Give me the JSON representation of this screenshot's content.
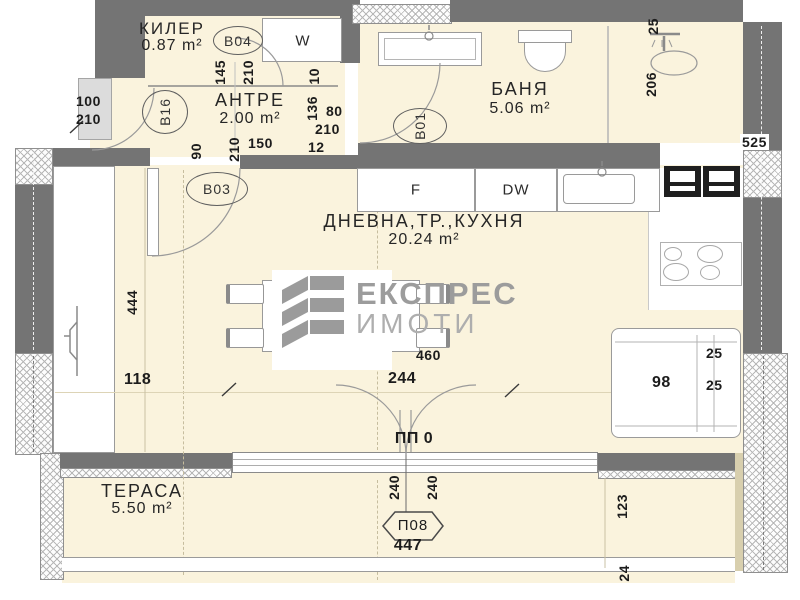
{
  "logo": {
    "title": "ЕКСПРЕС",
    "subtitle": "ИМОТИ"
  },
  "rooms": {
    "kiler": {
      "name": "КИЛЕР",
      "area": "0.87 m²",
      "tag": "B04"
    },
    "antre": {
      "name": "АНТРЕ",
      "area": "2.00 m²",
      "tag": "B16"
    },
    "banya": {
      "name": "БАНЯ",
      "area": "5.06 m²",
      "tag": "B01"
    },
    "living": {
      "name": "ДНЕВНА,ТР.,КУХНЯ",
      "area": "20.24 m²",
      "tag": "B03"
    },
    "terasa": {
      "name": "ТЕРАСА",
      "area": "5.50 m²"
    }
  },
  "openings": {
    "balcony_door": "ПП 0",
    "balcony_tag": "П08"
  },
  "appliances": {
    "fridge": "F",
    "dishwasher": "DW",
    "washer": "W",
    "washer_size": "60"
  },
  "dims": {
    "entry_w": "100",
    "entry_h": "210",
    "kiler_door_w": "145",
    "kiler_door_h": "210",
    "wall_10": "10",
    "wall_136": "136",
    "bath_door_w": "80",
    "bath_door_h": "210",
    "wall_12": "12",
    "hall_150": "150",
    "b03_w": "90",
    "b03_h": "210",
    "shower_25": "25",
    "shower_206": "206",
    "right_525": "525",
    "left_444": "444",
    "left_118": "118",
    "living_244": "244",
    "living_460": "460",
    "sofa_25a": "25",
    "sofa_98": "98",
    "sofa_25b": "25",
    "door_240a": "240",
    "door_240b": "240",
    "balcony_447": "447",
    "terrace_123": "123",
    "terrace_24": "24"
  }
}
